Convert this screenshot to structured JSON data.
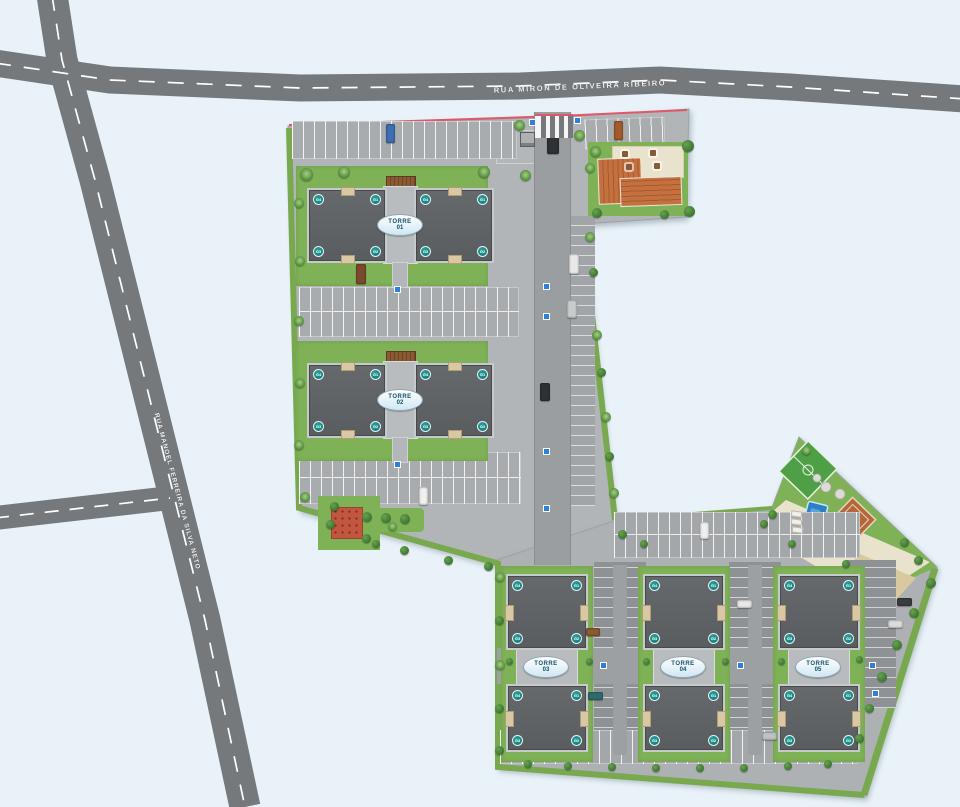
{
  "roads": {
    "horizontal_road_name": "RUA MIRON DE OLIVEIRA RIBEIRO",
    "diagonal_road_name": "RUA MANOEL FERREIRA DA SILVA NETO"
  },
  "towers": [
    {
      "name": "TORRE",
      "number": "01",
      "buildings": [
        {
          "badges": [
            "G4",
            "G1",
            "G3",
            "G2"
          ]
        },
        {
          "badges": [
            "G4",
            "G1",
            "G3",
            "G2"
          ]
        }
      ]
    },
    {
      "name": "TORRE",
      "number": "02",
      "buildings": [
        {
          "badges": [
            "G4",
            "G1",
            "G3",
            "G2"
          ]
        },
        {
          "badges": [
            "G4",
            "G1",
            "G3",
            "G2"
          ]
        }
      ]
    },
    {
      "name": "TORRE",
      "number": "03",
      "buildings": [
        {
          "badges": [
            "G4",
            "G1",
            "G3",
            "G2"
          ]
        },
        {
          "badges": [
            "G4",
            "G1",
            "G3",
            "G2"
          ]
        }
      ]
    },
    {
      "name": "TORRE",
      "number": "04",
      "buildings": [
        {
          "badges": [
            "G4",
            "G1",
            "G3",
            "G2"
          ]
        },
        {
          "badges": [
            "G4",
            "G1",
            "G3",
            "G2"
          ]
        }
      ]
    },
    {
      "name": "TORRE",
      "number": "05",
      "buildings": [
        {
          "badges": [
            "G4",
            "G1",
            "G3",
            "G2"
          ]
        },
        {
          "badges": [
            "G4",
            "G1",
            "G3",
            "G2"
          ]
        }
      ]
    }
  ],
  "colors": {
    "background": "#e9f2f8",
    "asphalt": "#75797c",
    "road_dash": "#ffffff",
    "parcel": "#b2b5b7",
    "parking_light": "#a9acae",
    "parking_dark": "#8f9294",
    "grass": "#7fb257",
    "building_roof": "#5f6366",
    "walkway": "#c7cacb",
    "clubhouse_roof": "#c4713f",
    "pool": "#2b7fc2",
    "sport_court": "#b5673a",
    "soccer_field": "#4f9f46",
    "sand": "#d9c9a0",
    "unit_badge": "#147f7c",
    "tower_label_text": "#12506b",
    "property_line": "#e0566b",
    "accessible_marker": "#2f7fd6"
  }
}
